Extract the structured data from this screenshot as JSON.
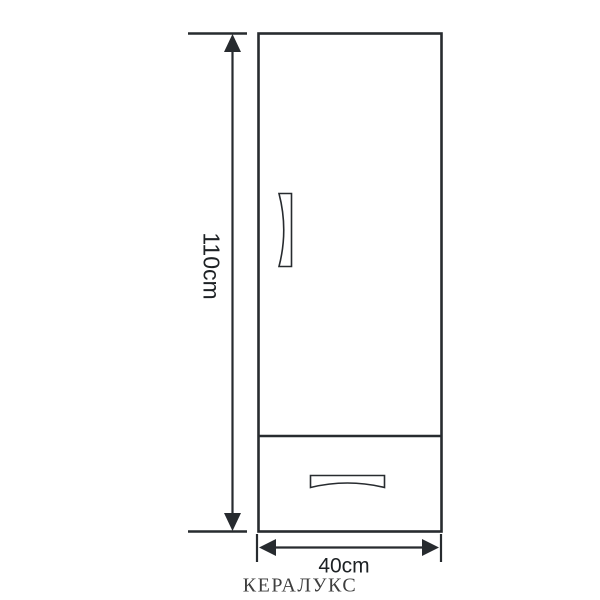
{
  "figure": {
    "type": "furniture-dimension-diagram",
    "subject": "single-door cabinet with bottom drawer",
    "height_label": "110cm",
    "width_label": "40cm",
    "brand": "КЕРАЛУКС"
  },
  "colors": {
    "line": "#272b2f",
    "text": "#1d2124",
    "brand-text": "#3e3e3e",
    "background": "#ffffff"
  }
}
